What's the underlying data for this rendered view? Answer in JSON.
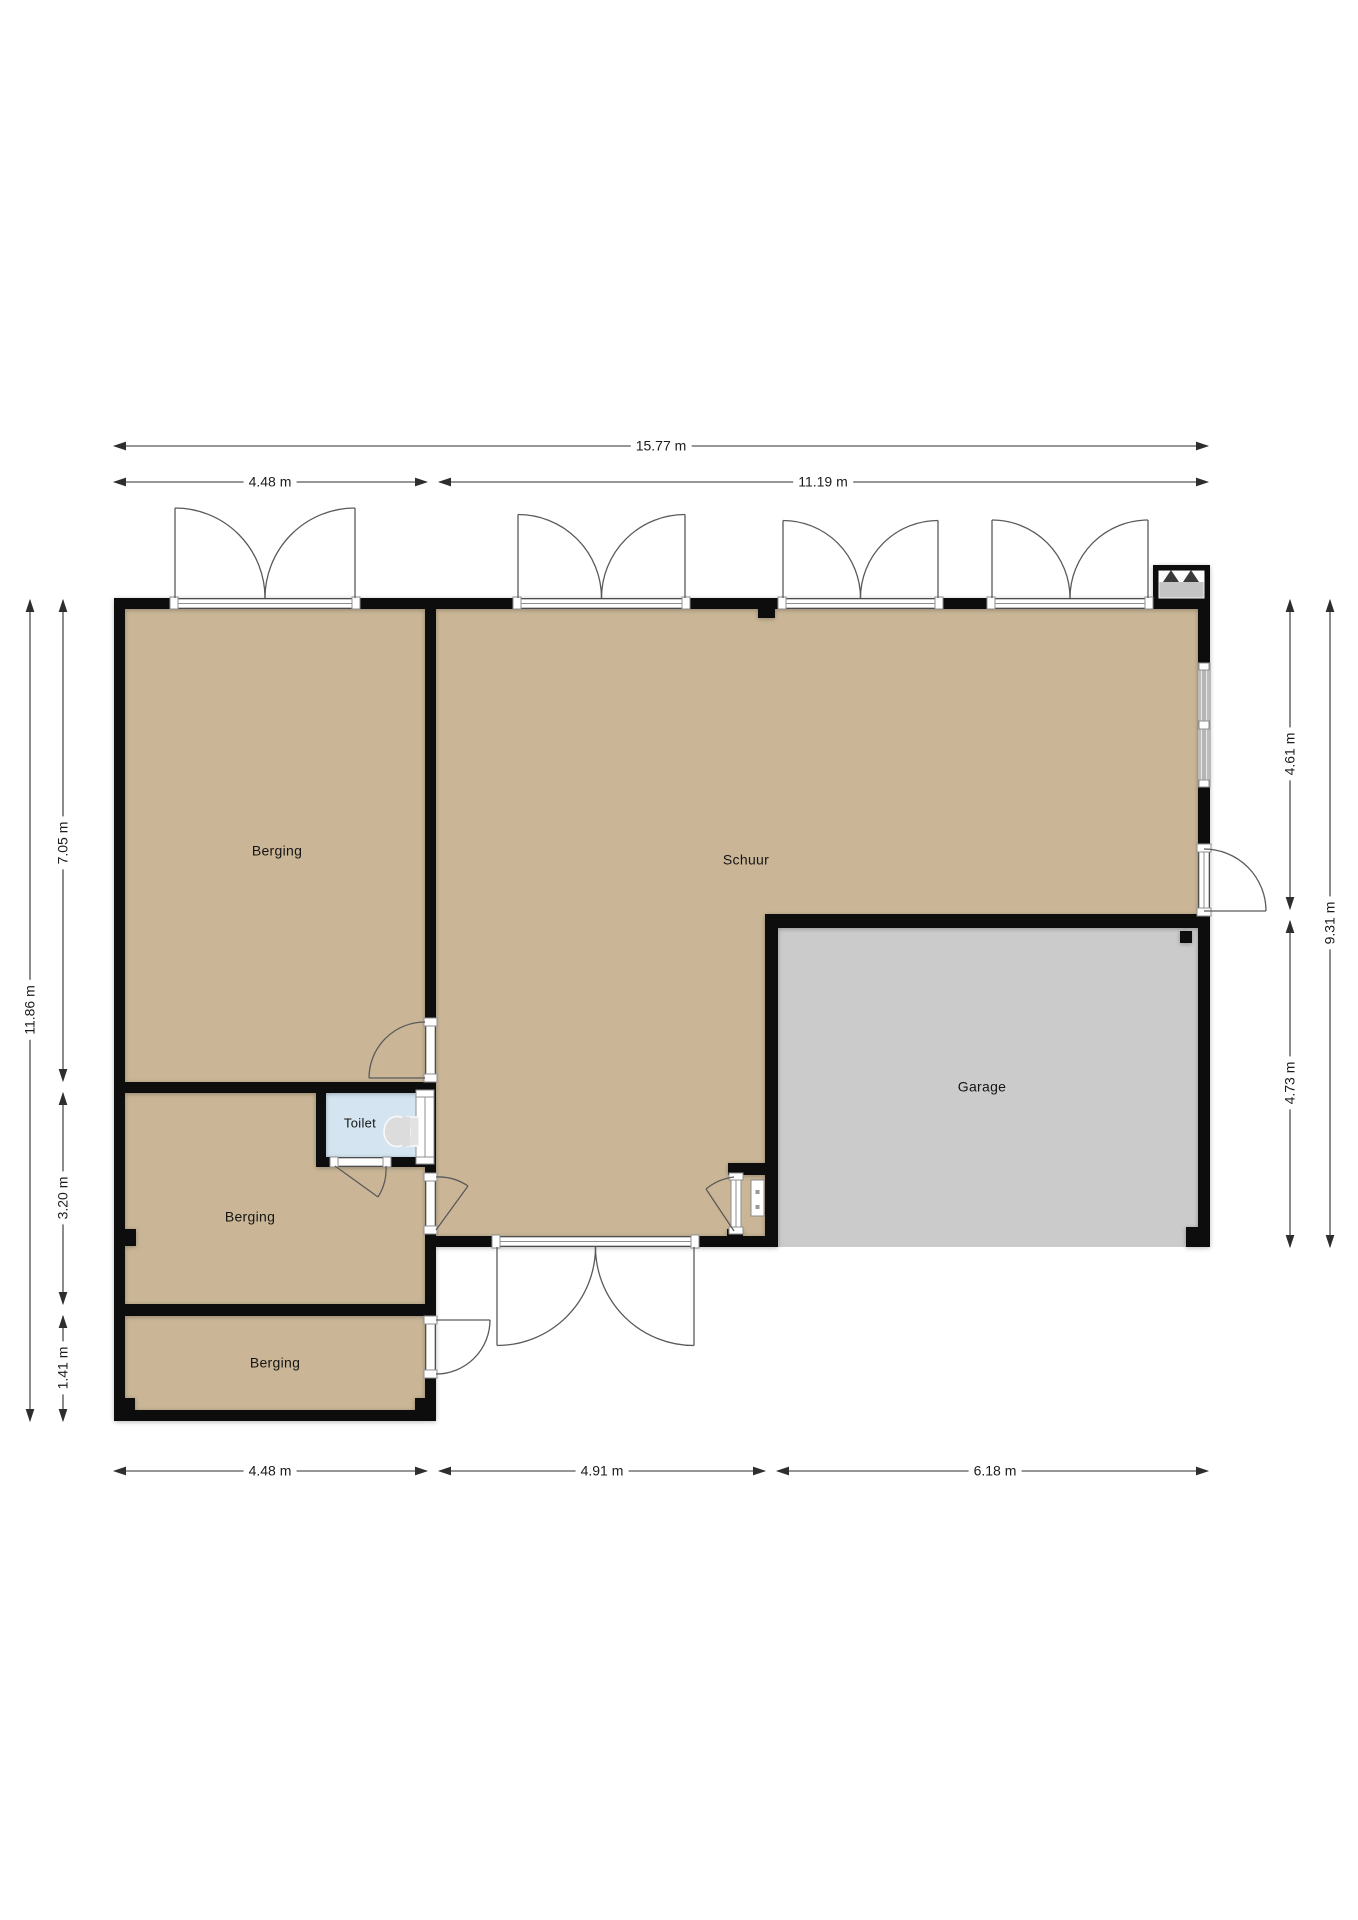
{
  "plan_title": "Floor plan",
  "rooms": {
    "berging_top": {
      "label": "Berging"
    },
    "schuur": {
      "label": "Schuur"
    },
    "toilet": {
      "label": "Toilet"
    },
    "berging_mid": {
      "label": "Berging"
    },
    "berging_bot": {
      "label": "Berging"
    },
    "garage": {
      "label": "Garage"
    }
  },
  "dimensions": {
    "top_total": {
      "label": "15.77 m"
    },
    "top_left": {
      "label": "4.48 m"
    },
    "top_right": {
      "label": "11.19 m"
    },
    "left_total": {
      "label": "11.86 m"
    },
    "left_seg1": {
      "label": "7.05 m"
    },
    "left_seg2": {
      "label": "3.20 m"
    },
    "left_seg3": {
      "label": "1.41 m"
    },
    "right_seg1": {
      "label": "4.61 m"
    },
    "right_seg2": {
      "label": "4.73 m"
    },
    "right_total": {
      "label": "9.31 m"
    },
    "bottom_left": {
      "label": "4.48 m"
    },
    "bottom_mid": {
      "label": "4.91 m"
    },
    "bottom_right": {
      "label": "6.18 m"
    }
  },
  "colors": {
    "floor_tan": "#cab696",
    "floor_gray": "#cbcbcb",
    "toilet_blue": "#d4e5f1",
    "wall": "#0a0a0a",
    "dim_line": "#2e2e2e",
    "door_line": "#5a5a5a",
    "sill_stroke": "#8f8f8f"
  }
}
